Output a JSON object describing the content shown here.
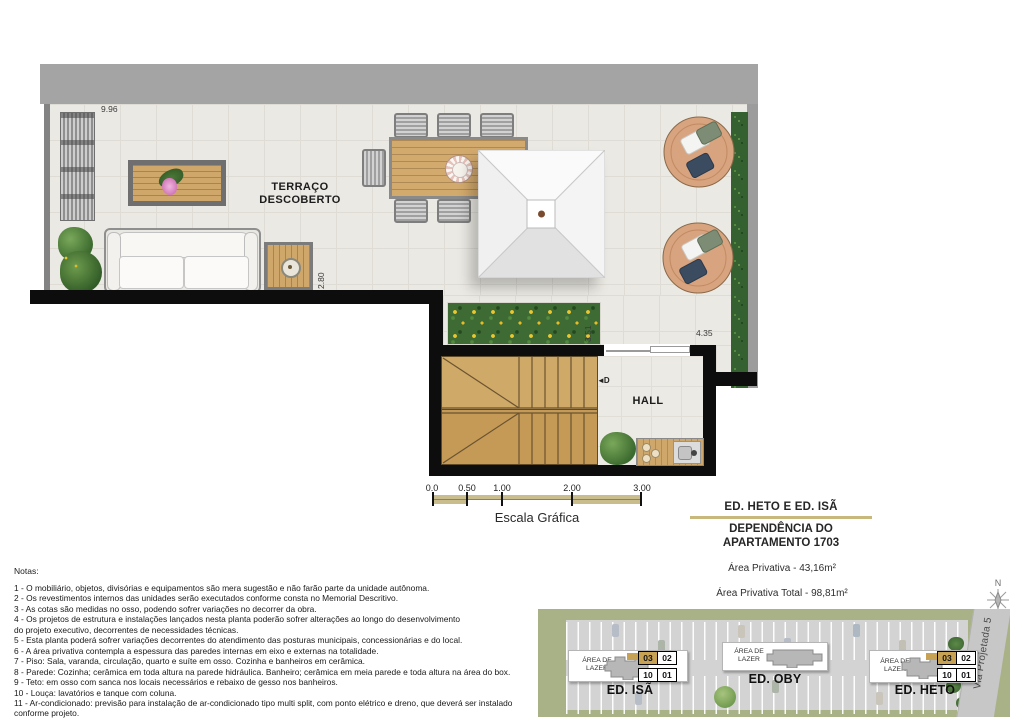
{
  "colors": {
    "accent": "#c9b87c",
    "highlight": "#c8a254",
    "wall": "#0d0d0d",
    "map_green": "#a9b287"
  },
  "plan": {
    "terrace_label": "TERRAÇO\nDESCOBERTO",
    "hall_label": "HALL",
    "door_marker": "◄D",
    "dim_top": "9.96",
    "dim_sofa": "2.80",
    "dim_planter": "3.51",
    "dim_hall": "4.35"
  },
  "scale_bar": {
    "ticks": [
      "0.0",
      "0.50",
      "1.00",
      "2.00",
      "3.00"
    ],
    "caption": "Escala Gráfica"
  },
  "title_block": {
    "project": "ED. HETO E ED. ISÃ",
    "dependency_line1": "DEPENDÊNCIA DO",
    "dependency_line2": "APARTAMENTO 1703",
    "private_area": "Área Privativa - 43,16m²",
    "private_area_total": "Área Privativa Total - 98,81m²"
  },
  "compass": {
    "north_label": "N"
  },
  "notes": {
    "heading": "Notas:",
    "lines": [
      "1 - O mobiliário, objetos, divisórias e equipamentos são mera sugestão e não farão parte da unidade autônoma.",
      "2 - Os revestimentos internos das unidades serão executados conforme consta no Memorial Descritivo.",
      "3 - As cotas são medidas no osso, podendo sofrer variações no decorrer da obra.",
      "4 - Os projetos de estrutura e instalações lançados nesta planta poderão sofrer alterações ao longo do desenvolvimento",
      "do projeto executivo, decorrentes de necessidades técnicas.",
      "5 - Esta planta poderá sofrer variações decorrentes do atendimento das posturas municipais, concessionárias e do local.",
      "6 - A área privativa contempla a espessura das paredes internas em eixo e externas na totalidade.",
      "7 - Piso: Sala, varanda, circulação, quarto e suíte em osso. Cozinha e banheiros em cerâmica.",
      "8 - Parede: Cozinha; cerâmica em toda altura na parede hidráulica. Banheiro; cerâmica em meia parede e toda altura na área do box.",
      "9 - Teto: em osso com sanca nos locais necessários e rebaixo de gesso nos banheiros.",
      "10 - Louça: lavatórios e tanque com coluna.",
      "11 - Ar-condicionado: previsão para instalação de ar-condicionado tipo multi split, com ponto elétrico e dreno, que deverá ser instalado",
      "conforme projeto."
    ]
  },
  "site_map": {
    "road_label": "Via Projetada 5",
    "buildings": [
      {
        "name": "ED. ISÃ",
        "area_label": "ÁREA DE\nLAZER",
        "units": [
          "03",
          "02",
          "10",
          "01"
        ]
      },
      {
        "name": "ED. OBY",
        "area_label": "ÁREA DE\nLAZER",
        "units": []
      },
      {
        "name": "ED. HETO",
        "area_label": "ÁREA DE\nLAZER",
        "units": [
          "03",
          "02",
          "10",
          "01"
        ]
      }
    ]
  }
}
